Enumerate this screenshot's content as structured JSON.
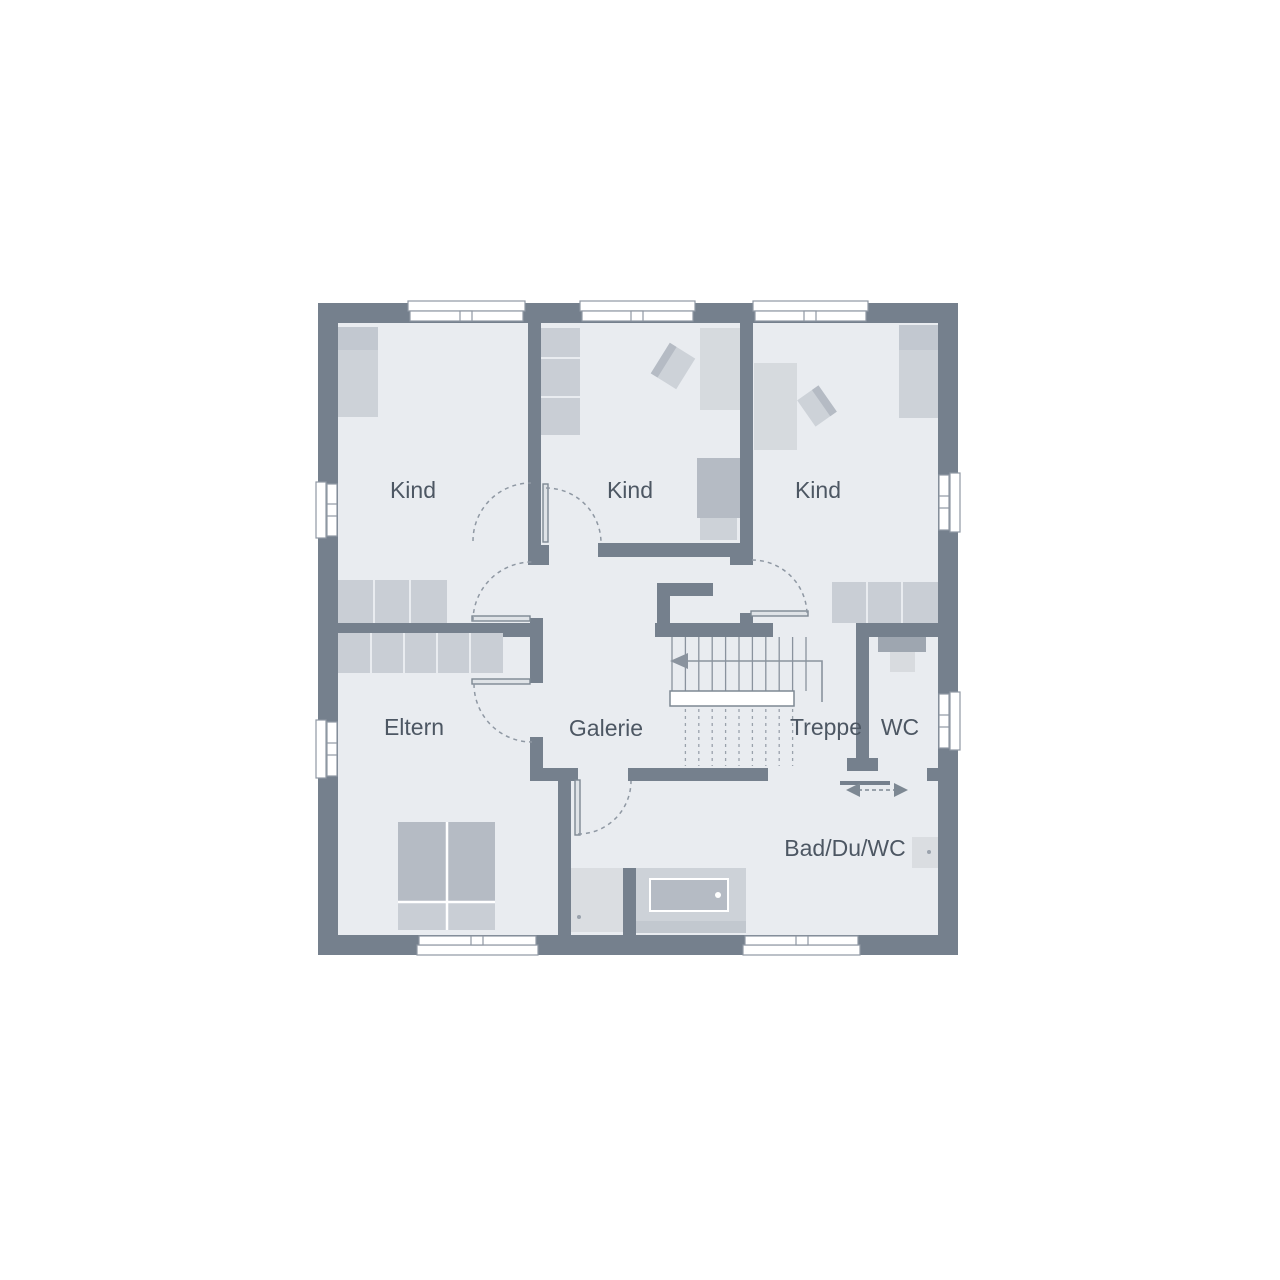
{
  "plan": {
    "title": "Obergeschoss Grundriss",
    "rooms": [
      {
        "label": "Kind"
      },
      {
        "label": "Kind"
      },
      {
        "label": "Kind"
      },
      {
        "label": "Eltern"
      },
      {
        "label": "Galerie"
      },
      {
        "label": "Treppe"
      },
      {
        "label": "WC"
      },
      {
        "label": "Bad/Du/WC"
      }
    ],
    "colors": {
      "background": "#ffffff",
      "wall": "#75808d",
      "floor": "#e9ecf0",
      "furniture_light": "#d6dade",
      "furniture_mid": "#cdd2d8",
      "furniture_dark": "#b5bbc4",
      "line": "#8f98a3",
      "text": "#4d5763"
    }
  }
}
